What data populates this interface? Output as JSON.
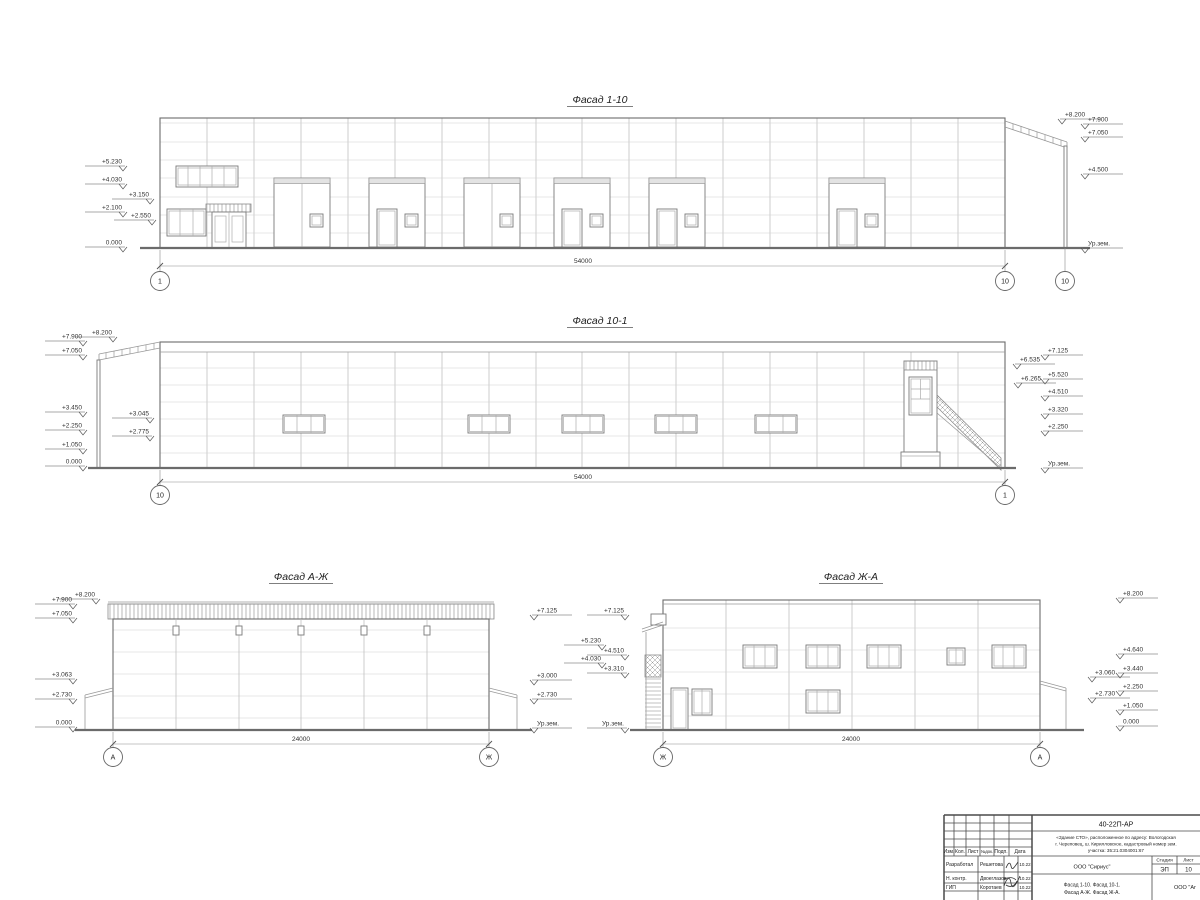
{
  "drawing": {
    "f110": {
      "title": "Фасад 1-10",
      "dim": "54000",
      "axes": [
        "1",
        "10",
        "10"
      ],
      "marks": [
        "+5.230",
        "+4.030",
        "+3.150",
        "+2.100",
        "+2.550",
        "0.000",
        "+8.200",
        "+7.900",
        "+7.050",
        "+4.500",
        "Ур.зем."
      ]
    },
    "f101": {
      "title": "Фасад 10-1",
      "dim": "54000",
      "axes": [
        "10",
        "1"
      ],
      "marks": [
        "+7.900",
        "+7.050",
        "+8.200",
        "+3.450",
        "+2.250",
        "+1.050",
        "0.000",
        "+3.045",
        "+2.775",
        "+7.125",
        "+6.535",
        "+6.265",
        "+5.520",
        "+4.510",
        "+3.320",
        "+2.250",
        "Ур.зем."
      ]
    },
    "faj": {
      "title": "Фасад А-Ж",
      "dim": "24000",
      "axes": [
        "А",
        "Ж"
      ],
      "marks": [
        "+7.900",
        "+8.200",
        "+7.050",
        "+3.063",
        "+2.730",
        "0.000",
        "+7.125",
        "+3.000",
        "+2.730",
        "Ур.зем."
      ]
    },
    "fja": {
      "title": "Фасад Ж-А",
      "dim": "24000",
      "axes": [
        "Ж",
        "А"
      ],
      "marks": [
        "+7.125",
        "+5.230",
        "+4.510",
        "+4.030",
        "+3.310",
        "Ур.зем.",
        "+8.200",
        "+4.640",
        "+3.440",
        "+2.250",
        "+1.050",
        "0.000",
        "+3.060",
        "+2.730"
      ]
    }
  },
  "titleblock": {
    "doc_number": "40-22П-АР",
    "project_line1": "«Здание СТО», расположенное по адресу: Вологодская",
    "project_line2": "г. Череповец, ш. Кирилловское, кадастровый номер зем.",
    "project_line3": "участка: 35:21.0304001:67",
    "cols": [
      "Изм.",
      "Кол.",
      "Лист",
      "№док.",
      "Подп.",
      "Дата"
    ],
    "rows": [
      {
        "role": "Разработал",
        "name": "Решетова",
        "date": "10.22"
      },
      {
        "role": "Н. контр.",
        "name": "Двоеглазов",
        "date": "10.22"
      },
      {
        "role": "ГИП",
        "name": "Коротаев",
        "date": "10.22"
      }
    ],
    "org": "ООО \"Сириус\"",
    "stage_label": "Стадия",
    "sheet_label": "Лист",
    "stage": "ЭП",
    "sheet_no": "10",
    "content_line1": "Фасад 1-10. Фасад 10-1.",
    "content_line2": "Фасад А-Ж. Фасад Ж-А.",
    "org2": "ООО \"Аг"
  }
}
